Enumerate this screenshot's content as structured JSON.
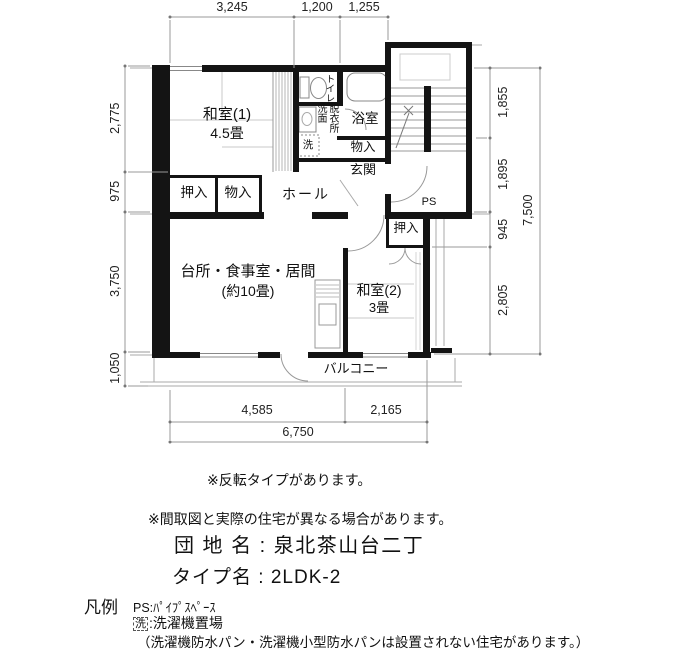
{
  "plan": {
    "rooms": {
      "washitsu1": {
        "name": "和室(1)",
        "size": "4.5畳"
      },
      "washitsu2": {
        "name": "和室(2)",
        "size": "3畳"
      },
      "ldk": {
        "name": "台所・食事室・居間",
        "size": "(約10畳)"
      },
      "hall": {
        "name": "ホール"
      },
      "genkan": {
        "name": "玄関"
      },
      "bath": {
        "name": "浴室"
      },
      "toilet": {
        "name": "トイレ"
      },
      "washroom": {
        "col1": "洗面",
        "col2": "脱衣所"
      },
      "washer": {
        "name": "洗"
      },
      "oshiire1": {
        "name": "押入"
      },
      "monoire1": {
        "name": "物入"
      },
      "monoire2": {
        "name": "物入"
      },
      "oshiire2": {
        "name": "押入"
      },
      "balcony": {
        "name": "バルコニー"
      },
      "ps": {
        "name": "PS"
      }
    },
    "dimensions": {
      "top": [
        "3,245",
        "1,200",
        "1,255"
      ],
      "left": [
        "2,775",
        "975",
        "3,750",
        "1,050"
      ],
      "right": [
        "1,855",
        "1,895",
        "945",
        "2,805"
      ],
      "right_total": "7,500",
      "bottom": [
        "4,585",
        "2,165"
      ],
      "bottom_total": "6,750"
    }
  },
  "notes": {
    "flip": "※反転タイプがあります。",
    "difference": "※間取図と実際の住宅が異なる場合があります。",
    "estate_name": "団 地 名 : 泉北茶山台二丁",
    "type_name": "タイプ名 : 2LDK-2"
  },
  "legend": {
    "title": "凡例",
    "ps": "PS:ﾊﾟｲﾌﾟｽﾍﾟｰｽ",
    "washer_symbol": "洗",
    "washer_label": ":洗濯機置場",
    "washer_note": "（洗濯機防水パン・洗濯機小型防水パンは設置されない住宅があります。）"
  }
}
